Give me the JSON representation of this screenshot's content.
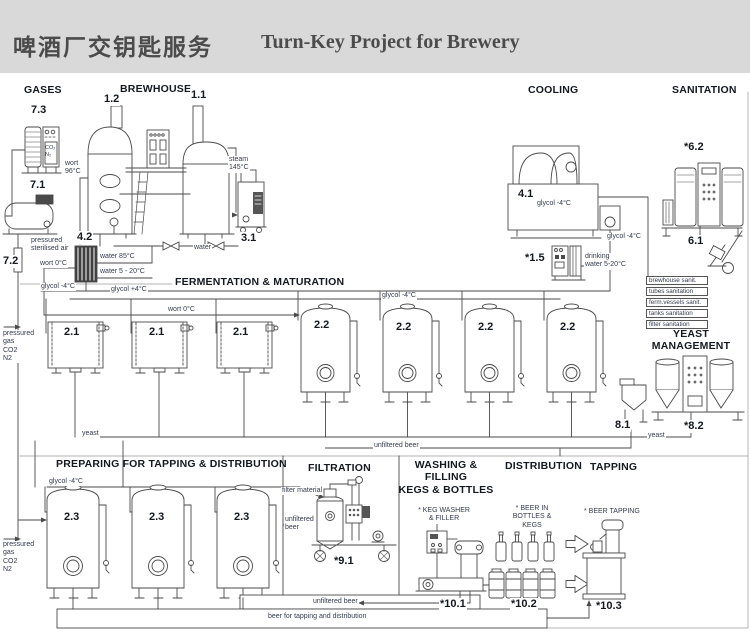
{
  "header": {
    "title_zh": "啤酒厂交钥匙服务",
    "title_en": "Turn-Key Project for Brewery"
  },
  "colors": {
    "header_bg": "#d9d9d9",
    "title_text": "#4b4b4b",
    "line_art": "#4a4a4a",
    "label_text": "#333a4d"
  },
  "diagram": {
    "labels": [
      {
        "name": "section-gases",
        "text": "GASES",
        "x": 24,
        "y": 84,
        "cls": "sec"
      },
      {
        "name": "section-brewhouse",
        "text": "BREWHOUSE",
        "x": 120,
        "y": 83,
        "cls": "sec"
      },
      {
        "name": "section-cooling",
        "text": "COOLING",
        "x": 528,
        "y": 84,
        "cls": "sec"
      },
      {
        "name": "section-sanitation",
        "text": "SANITATION",
        "x": 672,
        "y": 84,
        "cls": "sec"
      },
      {
        "name": "section-fermentation",
        "text": "FERMENTATION & MATURATION",
        "x": 175,
        "y": 276,
        "cls": "sec"
      },
      {
        "name": "section-yeast-management",
        "text": "YEAST\nMANAGEMENT",
        "x": 650,
        "y": 328,
        "cls": "sec",
        "w": 82
      },
      {
        "name": "section-preparing",
        "text": "PREPARING FOR TAPPING & DISTRIBUTION",
        "x": 56,
        "y": 458,
        "cls": "sec"
      },
      {
        "name": "section-filtration",
        "text": "FILTRATION",
        "x": 308,
        "y": 462,
        "cls": "sec"
      },
      {
        "name": "section-washing",
        "text": "WASHING & FILLING\nKEGS & BOTTLES",
        "x": 397,
        "y": 459,
        "cls": "sec",
        "w": 98
      },
      {
        "name": "section-distribution",
        "text": "DISTRIBUTION",
        "x": 505,
        "y": 460,
        "cls": "sec"
      },
      {
        "name": "section-tapping",
        "text": "TAPPING",
        "x": 590,
        "y": 461,
        "cls": "sec"
      },
      {
        "name": "equip-7-3",
        "text": "7.3",
        "x": 30,
        "y": 104,
        "cls": "num"
      },
      {
        "name": "equip-1-2",
        "text": "1.2",
        "x": 103,
        "y": 93,
        "cls": "num"
      },
      {
        "name": "equip-1-1",
        "text": "1.1",
        "x": 190,
        "y": 89,
        "cls": "num"
      },
      {
        "name": "equip-7-1",
        "text": "7.1",
        "x": 29,
        "y": 179,
        "cls": "num"
      },
      {
        "name": "equip-7-2",
        "text": "7.2",
        "x": 2,
        "y": 255,
        "cls": "num"
      },
      {
        "name": "equip-4-2",
        "text": "4.2",
        "x": 76,
        "y": 231,
        "cls": "num"
      },
      {
        "name": "equip-3-1",
        "text": "3.1",
        "x": 240,
        "y": 232,
        "cls": "num"
      },
      {
        "name": "equip-4-1",
        "text": "4.1",
        "x": 517,
        "y": 188,
        "cls": "num"
      },
      {
        "name": "equip-1-5",
        "text": "*1.5",
        "x": 524,
        "y": 252,
        "cls": "num"
      },
      {
        "name": "equip-6-2",
        "text": "*6.2",
        "x": 683,
        "y": 141,
        "cls": "num"
      },
      {
        "name": "equip-6-1",
        "text": "6.1",
        "x": 687,
        "y": 235,
        "cls": "num"
      },
      {
        "name": "equip-2-1-1",
        "text": "2.1",
        "x": 63,
        "y": 326,
        "cls": "num"
      },
      {
        "name": "equip-2-1-2",
        "text": "2.1",
        "x": 148,
        "y": 326,
        "cls": "num"
      },
      {
        "name": "equip-2-1-3",
        "text": "2.1",
        "x": 232,
        "y": 326,
        "cls": "num"
      },
      {
        "name": "equip-2-2-1",
        "text": "2.2",
        "x": 313,
        "y": 319,
        "cls": "num"
      },
      {
        "name": "equip-2-2-2",
        "text": "2.2",
        "x": 395,
        "y": 321,
        "cls": "num"
      },
      {
        "name": "equip-2-2-3",
        "text": "2.2",
        "x": 477,
        "y": 321,
        "cls": "num"
      },
      {
        "name": "equip-2-2-4",
        "text": "2.2",
        "x": 559,
        "y": 321,
        "cls": "num"
      },
      {
        "name": "equip-8-1",
        "text": "8.1",
        "x": 614,
        "y": 419,
        "cls": "num"
      },
      {
        "name": "equip-8-2",
        "text": "*8.2",
        "x": 683,
        "y": 420,
        "cls": "num"
      },
      {
        "name": "equip-2-3-1",
        "text": "2.3",
        "x": 63,
        "y": 511,
        "cls": "num"
      },
      {
        "name": "equip-2-3-2",
        "text": "2.3",
        "x": 148,
        "y": 511,
        "cls": "num"
      },
      {
        "name": "equip-2-3-3",
        "text": "2.3",
        "x": 233,
        "y": 511,
        "cls": "num"
      },
      {
        "name": "equip-9-1",
        "text": "*9.1",
        "x": 333,
        "y": 555,
        "cls": "num"
      },
      {
        "name": "equip-10-1",
        "text": "*10.1",
        "x": 439,
        "y": 598,
        "cls": "num"
      },
      {
        "name": "equip-10-2",
        "text": "*10.2",
        "x": 510,
        "y": 598,
        "cls": "num"
      },
      {
        "name": "equip-10-3",
        "text": "*10.3",
        "x": 595,
        "y": 600,
        "cls": "num"
      },
      {
        "name": "gas-co2-n2-label",
        "text": "CO₂\nN₂",
        "x": 45,
        "y": 145,
        "cls": "xs"
      },
      {
        "name": "wort-96-label",
        "text": "wort\n96°C",
        "x": 64,
        "y": 160,
        "cls": "sm"
      },
      {
        "name": "steam-145-label",
        "text": "steam\n145°C",
        "x": 228,
        "y": 156,
        "cls": "sm"
      },
      {
        "name": "sterilised-air-label",
        "text": "pressured\nsterilised air",
        "x": 30,
        "y": 237,
        "cls": "sm"
      },
      {
        "name": "wort-0-label-1",
        "text": "wort 0°C",
        "x": 39,
        "y": 260,
        "cls": "sm"
      },
      {
        "name": "water-85-label",
        "text": "water 85°C",
        "x": 99,
        "y": 253,
        "cls": "sm"
      },
      {
        "name": "water-5-20-label",
        "text": "water 5 - 20°C",
        "x": 99,
        "y": 268,
        "cls": "sm"
      },
      {
        "name": "water-label",
        "text": "water",
        "x": 193,
        "y": 244,
        "cls": "sm"
      },
      {
        "name": "glycol-label-1",
        "text": "glycol -4°C",
        "x": 40,
        "y": 283,
        "cls": "sm"
      },
      {
        "name": "glycol-label-2",
        "text": "glycol +4°C",
        "x": 110,
        "y": 286,
        "cls": "sm"
      },
      {
        "name": "wort-0-label-2",
        "text": "wort 0°C",
        "x": 167,
        "y": 306,
        "cls": "sm"
      },
      {
        "name": "glycol-label-3",
        "text": "glycol -4°C",
        "x": 381,
        "y": 292,
        "cls": "sm"
      },
      {
        "name": "glycol-41-label",
        "text": "glycol -4°C",
        "x": 536,
        "y": 200,
        "cls": "sm"
      },
      {
        "name": "glycol-label-4",
        "text": "glycol -4°C",
        "x": 606,
        "y": 233,
        "cls": "sm"
      },
      {
        "name": "drinking-water-label",
        "text": "drinking\nwater 5-20°C",
        "x": 584,
        "y": 253,
        "cls": "sm"
      },
      {
        "name": "sanitation-list-brewhouse",
        "text": "brewhouse sanit.",
        "x": 646,
        "y": 276,
        "cls": "listbox"
      },
      {
        "name": "sanitation-list-tubes",
        "text": "tubes sanitation",
        "x": 646,
        "y": 287,
        "cls": "listbox"
      },
      {
        "name": "sanitation-list-ferm",
        "text": "ferm.vessels sanit.",
        "x": 646,
        "y": 298,
        "cls": "listbox"
      },
      {
        "name": "sanitation-list-tanks",
        "text": "tanks sanitation",
        "x": 646,
        "y": 309,
        "cls": "listbox"
      },
      {
        "name": "sanitation-list-filter",
        "text": "filter sanitation",
        "x": 646,
        "y": 320,
        "cls": "listbox"
      },
      {
        "name": "pressured-gas-label-1",
        "text": "pressured\ngas\nCO2\nN2",
        "x": 2,
        "y": 330,
        "cls": "sm"
      },
      {
        "name": "yeast-label-1",
        "text": "yeast",
        "x": 81,
        "y": 430,
        "cls": "sm"
      },
      {
        "name": "unfiltered-beer-label-1",
        "text": "unfiltered beer",
        "x": 373,
        "y": 442,
        "cls": "sm"
      },
      {
        "name": "yeast-label-2",
        "text": "yeast",
        "x": 647,
        "y": 432,
        "cls": "sm"
      },
      {
        "name": "glycol-label-5",
        "text": "glycol -4°C",
        "x": 48,
        "y": 478,
        "cls": "sm"
      },
      {
        "name": "pressured-gas-label-2",
        "text": "pressured\ngas\nCO2\nN2",
        "x": 2,
        "y": 541,
        "cls": "sm"
      },
      {
        "name": "filter-material-label",
        "text": "filter material",
        "x": 281,
        "y": 487,
        "cls": "sm"
      },
      {
        "name": "unfiltered-beer-label-2",
        "text": "unfiltered\nbeer",
        "x": 284,
        "y": 516,
        "cls": "sm"
      },
      {
        "name": "unfiltered-beer-label-3",
        "text": "unfiltered beer",
        "x": 312,
        "y": 598,
        "cls": "sm"
      },
      {
        "name": "beer-tapping-dist-label",
        "text": "beer for tapping and distribution",
        "x": 267,
        "y": 613,
        "cls": "sm"
      },
      {
        "name": "keg-washer-label",
        "text": "* KEG WASHER\n& FILLER",
        "x": 416,
        "y": 507,
        "cls": "sm",
        "w": 54
      },
      {
        "name": "beer-in-bottles-label",
        "text": "* BEER IN\nBOTTLES & KEGS",
        "x": 502,
        "y": 505,
        "cls": "sm",
        "w": 58
      },
      {
        "name": "beer-tapping-label",
        "text": "* BEER TAPPING",
        "x": 583,
        "y": 508,
        "cls": "sm"
      }
    ]
  }
}
